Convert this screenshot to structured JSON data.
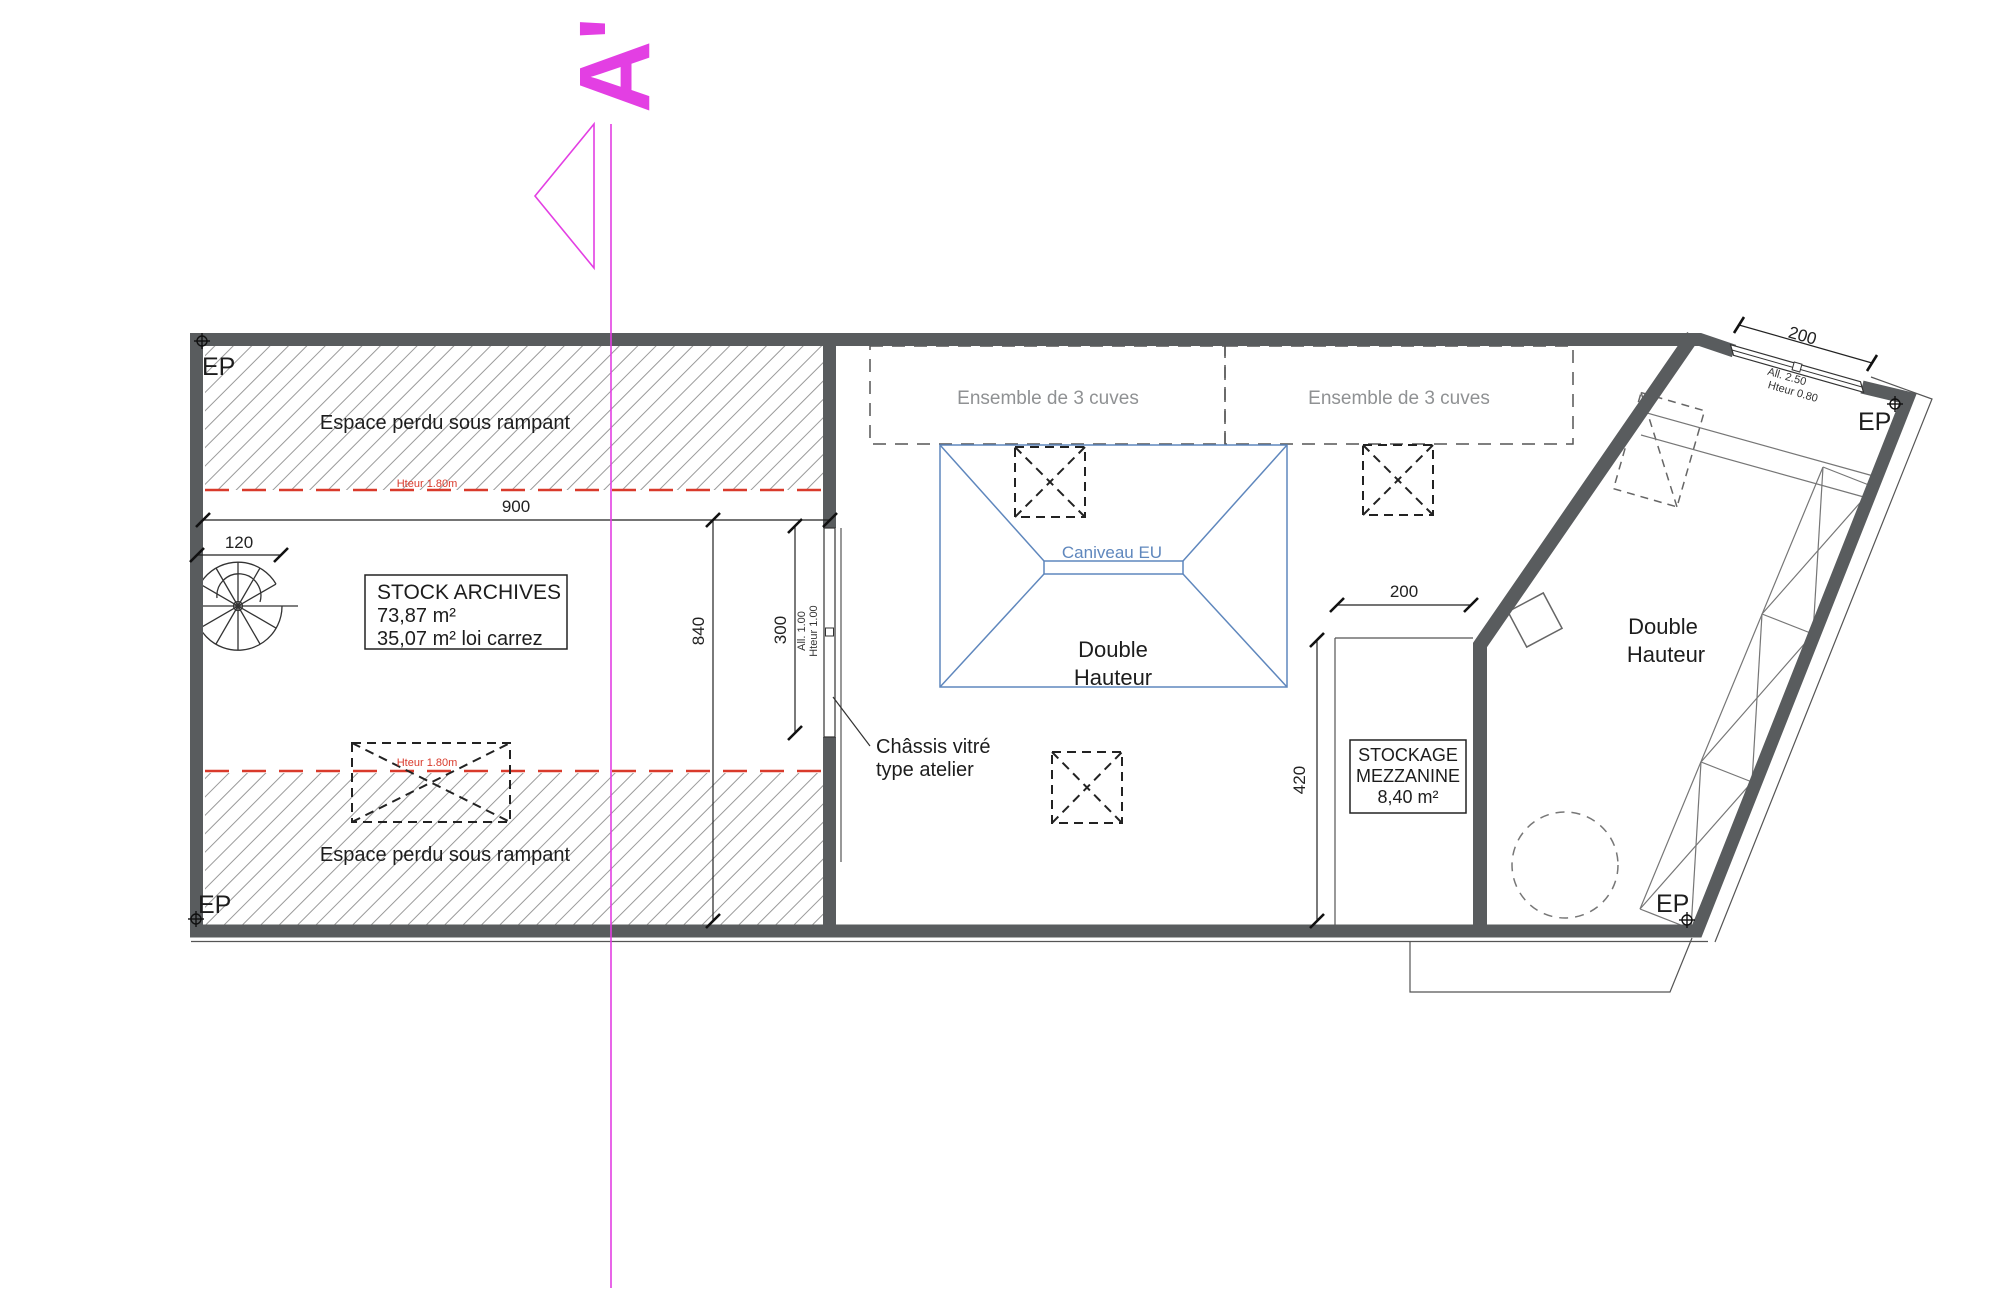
{
  "section": {
    "label": "A'"
  },
  "labels": {
    "ep": "EP",
    "espace_top": "Espace perdu sous rampant",
    "espace_bottom": "Espace perdu sous rampant",
    "hteur_top": "Hteur 1.80m",
    "hteur_bottom": "Hteur 1.80m",
    "cuves_left": "Ensemble de 3 cuves",
    "cuves_right": "Ensemble de 3 cuves",
    "caniveau": "Caniveau EU",
    "dh_mid_1": "Double",
    "dh_mid_2": "Hauteur",
    "dh_right_1": "Double",
    "dh_right_2": "Hauteur",
    "chassis_1": "Châssis vitré",
    "chassis_2": "type atelier"
  },
  "rooms": {
    "stock_archives": {
      "name": "STOCK ARCHIVES",
      "area": "73,87 m²",
      "carrez": "35,07 m² loi carrez"
    },
    "stockage": {
      "name1": "STOCKAGE",
      "name2": "MEZZANINE",
      "area": "8,40 m²"
    }
  },
  "dims": {
    "w900": "900",
    "w120": "120",
    "h840": "840",
    "h300": "300",
    "h420": "420",
    "w200_mezz": "200",
    "w200_top": "200",
    "win_left_1": "All. 1.00",
    "win_left_2": "Hteur 1.00",
    "win_top_1": "All. 2.50",
    "win_top_2": "Hteur 0.80"
  },
  "colors": {
    "wall": "#595c5e",
    "magenta": "#e33fe3",
    "red": "#d93a2b",
    "blue": "#5f87bd",
    "gray_text": "#8f9193",
    "hatch": "#9a9a9a"
  }
}
